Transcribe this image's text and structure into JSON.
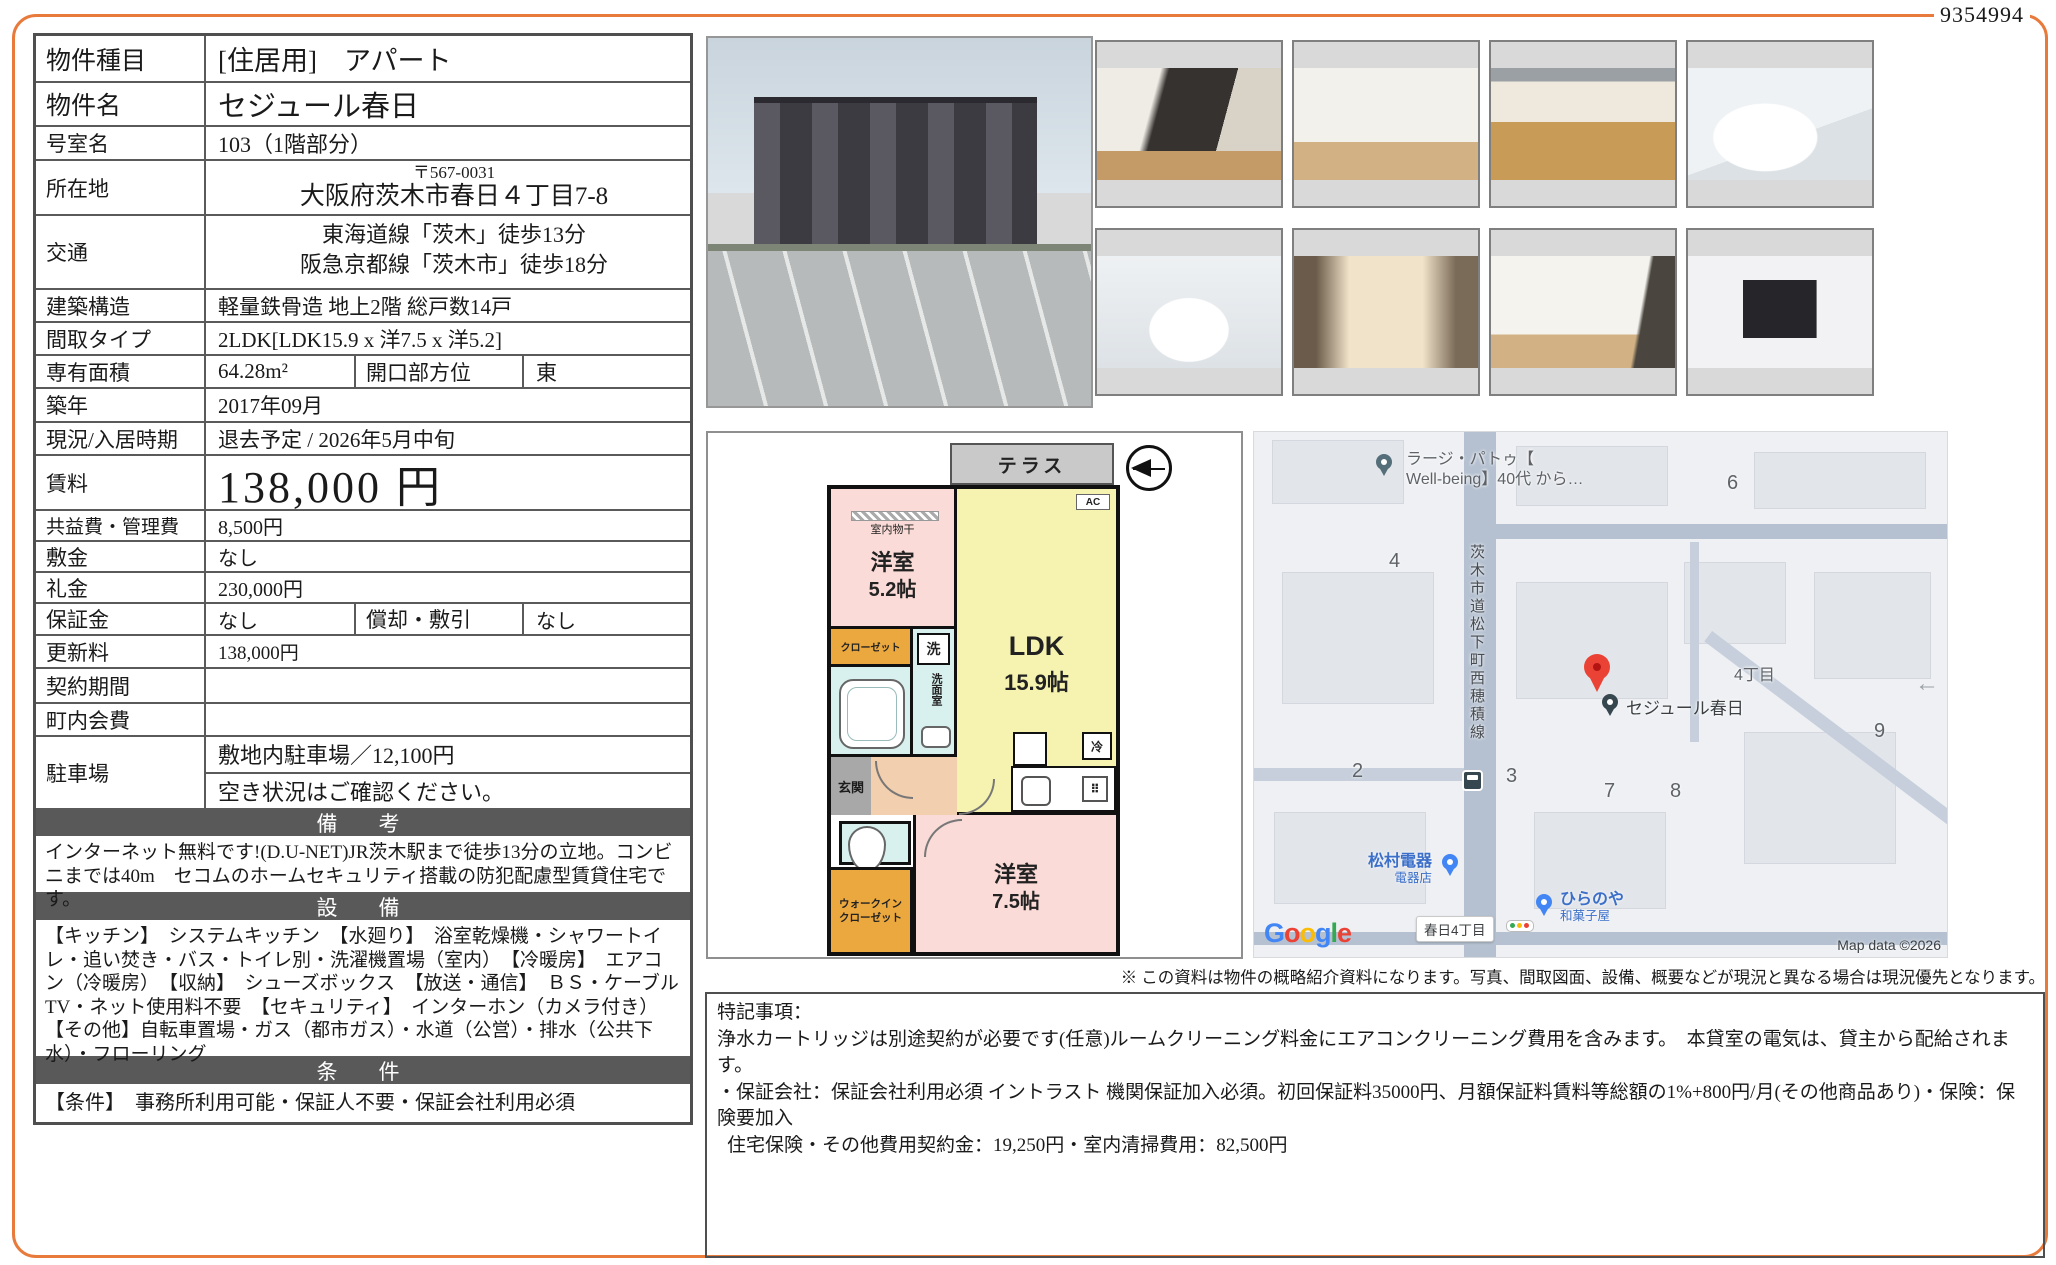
{
  "page": {
    "id_number": "9354994"
  },
  "table": {
    "property_type": {
      "label": "物件種目",
      "value": "[住居用]　アパート"
    },
    "property_name": {
      "label": "物件名",
      "value": "セジュール春日"
    },
    "room_no": {
      "label": "号室名",
      "value": "103（1階部分）"
    },
    "address": {
      "label": "所在地",
      "zip": "〒567-0031",
      "street": "大阪府茨木市春日４丁目7-8"
    },
    "access": {
      "label": "交通",
      "line1": "東海道線「茨木」徒歩13分",
      "line2": "阪急京都線「茨木市」徒歩18分"
    },
    "structure": {
      "label": "建築構造",
      "value": "軽量鉄骨造 地上2階 総戸数14戸"
    },
    "layout": {
      "label": "間取タイプ",
      "value": "2LDK[LDK15.9 x 洋7.5 x 洋5.2]"
    },
    "area": {
      "label": "専有面積",
      "value": "64.28m²",
      "label2": "開口部方位",
      "value2": "東"
    },
    "built": {
      "label": "築年",
      "value": "2017年09月"
    },
    "status": {
      "label": "現況/入居時期",
      "value": "退去予定 / 2026年5月中旬"
    },
    "rent": {
      "label": "賃料",
      "value": "138,000 円"
    },
    "common_fee": {
      "label": "共益費・管理費",
      "value": "8,500円"
    },
    "deposit": {
      "label": "敷金",
      "value": "なし"
    },
    "key_money": {
      "label": "礼金",
      "value": "230,000円"
    },
    "guarantee": {
      "label": "保証金",
      "value": "なし",
      "label2": "償却・敷引",
      "value2": "なし"
    },
    "renewal_fee": {
      "label": "更新料",
      "value": "138,000円"
    },
    "contract_term": {
      "label": "契約期間",
      "value": ""
    },
    "neighborhood_fee": {
      "label": "町内会費",
      "value": ""
    },
    "parking": {
      "label": "駐車場",
      "line1": "敷地内駐車場／12,100円",
      "line2": "空き状況はご確認ください。"
    },
    "remarks": {
      "header": "備　考",
      "text": "インターネット無料です!(D.U-NET)JR茨木駅まで徒歩13分の立地。コンビニまでは40m　セコムのホームセキュリティ搭載の防犯配慮型賃貸住宅です。"
    },
    "equipment": {
      "header": "設　備",
      "text": "【キッチン】　システムキッチン　【水廻り】　浴室乾燥機・シャワートイレ・追い焚き・バス・トイレ別・洗濯機置場（室内）　【冷暖房】　エアコン（冷暖房）　【収納】　シューズボックス　【放送・通信】　ＢＳ・ケーブルTV・ネット使用料不要　【セキュリティ】　インターホン（カメラ付き）　【その他】自転車置場・ガス（都市ガス）・水道（公営）・排水（公共下水）・フローリング"
    },
    "conditions": {
      "header": "条　件",
      "text": "【条件】　事務所利用可能・保証人不要・保証会社利用必須"
    }
  },
  "floorplan": {
    "terrace": "テラス",
    "indoor_drying": "室内物干",
    "bedroom1": "洋室",
    "bedroom1_size": "5.2帖",
    "ldk": "LDK",
    "ldk_size": "15.9帖",
    "ac": "AC",
    "closet": "クローゼット",
    "washer": "洗",
    "washroom": "洗面室",
    "entrance": "玄関",
    "wic_line1": "ウォークイン",
    "wic_line2": "クローゼット",
    "bedroom2": "洋室",
    "bedroom2_size": "7.5帖",
    "fridge": "冷"
  },
  "map": {
    "poi_top_line1": "ラージ・パトゥ【",
    "poi_top_line2": "Well-being】40代 から…",
    "road_name": "茨木市道松下町西穂積線",
    "property": "セジュール春日",
    "district": "4丁目",
    "numbers": [
      "2",
      "3",
      "4",
      "6",
      "7",
      "8",
      "9"
    ],
    "shop1_name": "松村電器",
    "shop1_type": "電器店",
    "shop2_name": "ひらのや",
    "shop2_type": "和菓子屋",
    "bus_stop": "春日4丁目",
    "google_letters": [
      "G",
      "o",
      "o",
      "g",
      "l",
      "e"
    ],
    "copyright": "Map data ©2026"
  },
  "disclaimer": "※ この資料は物件の概略紹介資料になります。写真、間取図面、設備、概要などが現況と異なる場合は現況優先となります。",
  "notes": {
    "title": "特記事項：",
    "line1": "浄水カートリッジは別途契約が必要です(任意)ルームクリーニング料金にエアコンクリーニング費用を含みます。　本貸室の電気は、貸主から配給されます。",
    "line2": "・保証会社：保証会社利用必須 イントラスト 機関保証加入必須。初回保証料35000円、月額保証料賃料等総額の1%+800円/月(その他商品あり)・保険：保険要加入",
    "line3": "住宅保険・その他費用契約金：19,250円・室内清掃費用：82,500円"
  }
}
